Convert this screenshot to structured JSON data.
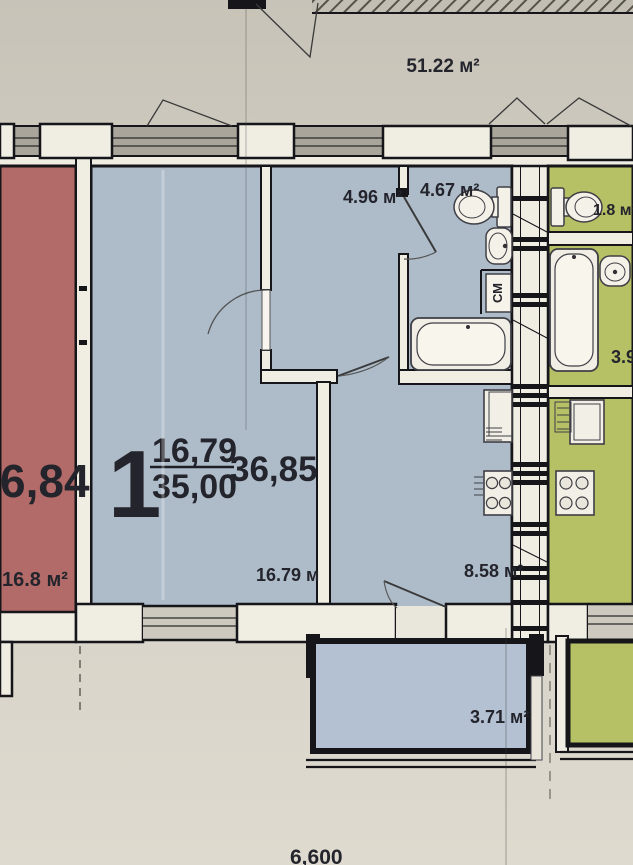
{
  "plan": {
    "upper_terrace_area": "51.22 м²",
    "left_apartment": {
      "number_fragment": "6,84",
      "room_area": "16.8 м²"
    },
    "apartment_1": {
      "number": "1",
      "living_area": "16,79",
      "total_area": "35,00",
      "overall_area": "36,85",
      "hallway_area": "4.96 м²",
      "bathroom_area": "4.67 м²",
      "living_room_area": "16.79 м",
      "kitchen_area": "8.58 м²",
      "balcony_area": "3.71 м²",
      "washing_machine_label": "СМ"
    },
    "right_apartment": {
      "wc_area": "1.8 м²",
      "bathroom_area_fragment": "3.9"
    },
    "bottom_dimension": "6,600",
    "colors": {
      "paper": "#d6d2c7",
      "apartment_fill": "#aebcca",
      "balcony_fill": "#b3c1d2",
      "neighbor_left_fill": "#b26b68",
      "neighbor_right_fill": "#b6c165",
      "wall_fill": "#f0ede3",
      "line": "#15151a"
    }
  }
}
